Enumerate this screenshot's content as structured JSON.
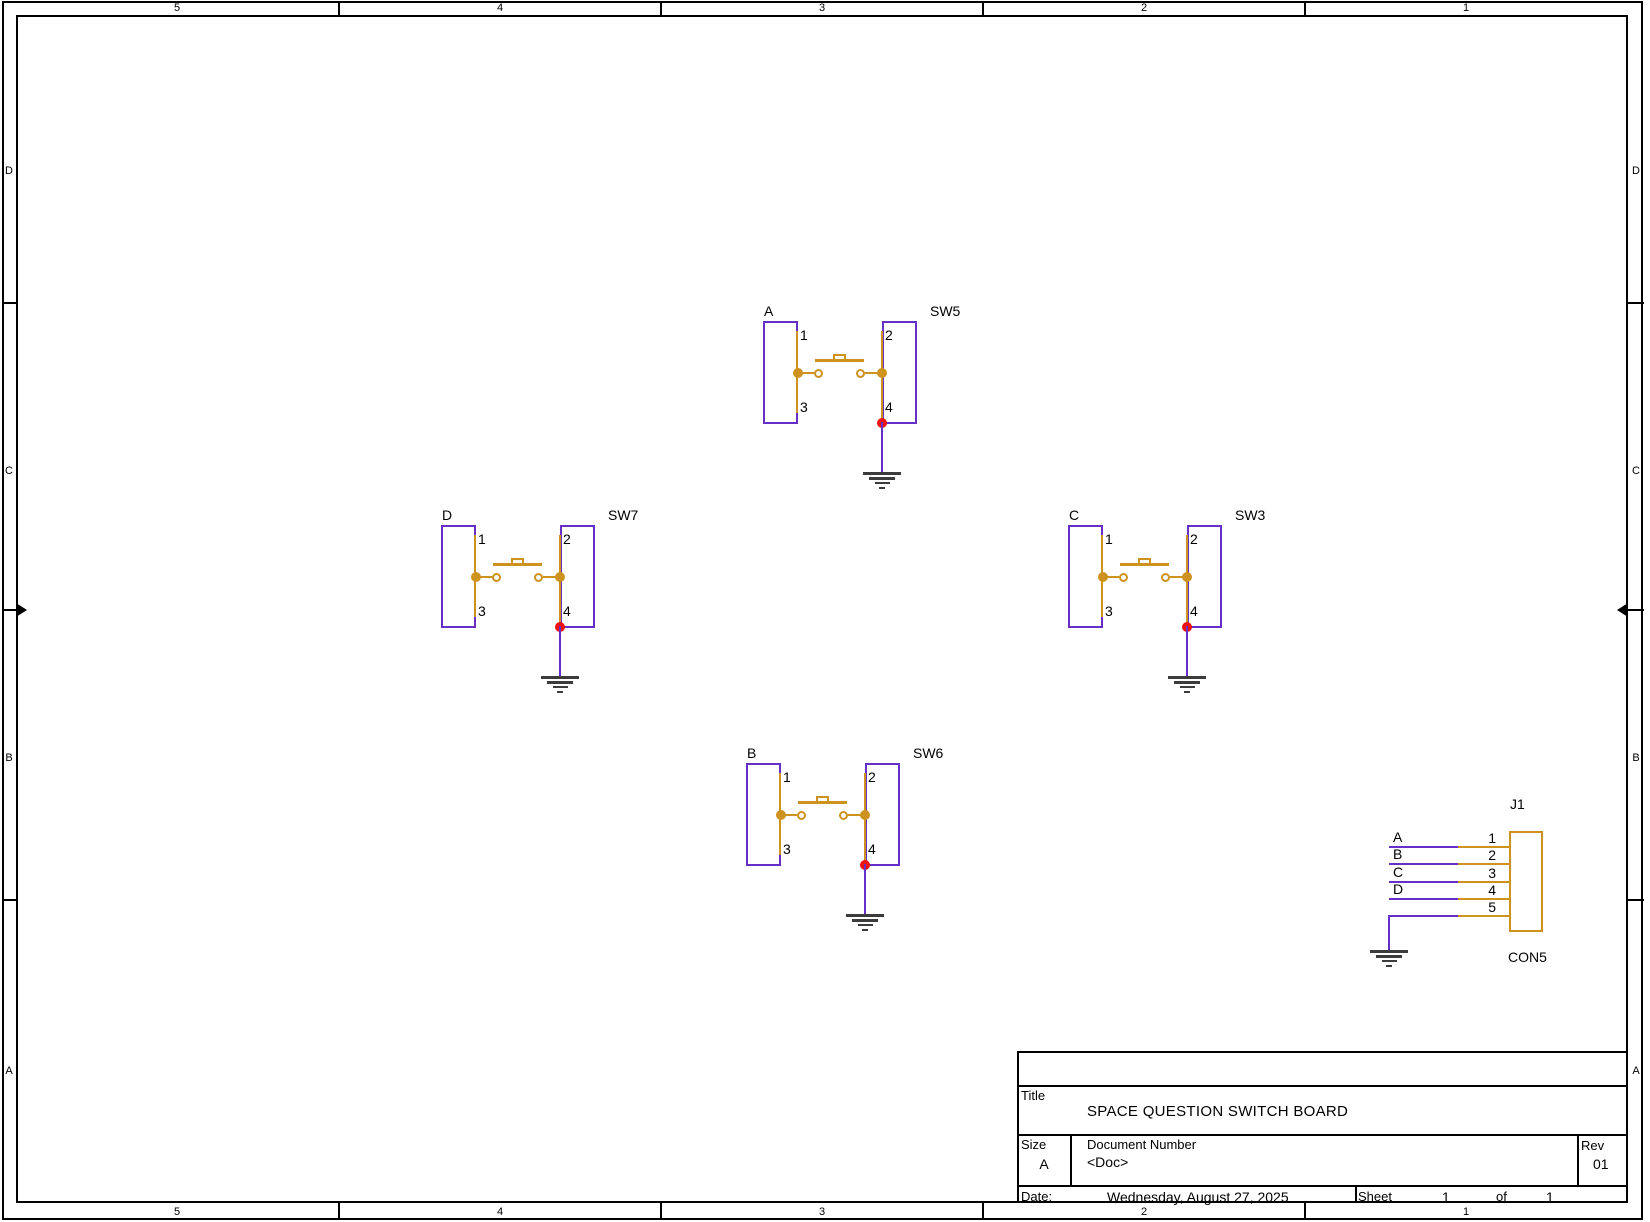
{
  "border": {
    "columns": [
      "5",
      "4",
      "3",
      "2",
      "1"
    ],
    "rows": [
      "D",
      "C",
      "B",
      "A"
    ]
  },
  "pin_numbers": [
    "1",
    "2",
    "3",
    "4"
  ],
  "switches": [
    {
      "name": "SW5",
      "net": "A"
    },
    {
      "name": "SW7",
      "net": "D"
    },
    {
      "name": "SW3",
      "net": "C"
    },
    {
      "name": "SW6",
      "net": "B"
    }
  ],
  "connector": {
    "name": "J1",
    "part": "CON5",
    "pins": [
      {
        "number": "1",
        "net": "A"
      },
      {
        "number": "2",
        "net": "B"
      },
      {
        "number": "3",
        "net": "C"
      },
      {
        "number": "4",
        "net": "D"
      },
      {
        "number": "5",
        "net": ""
      }
    ]
  },
  "title_block": {
    "title_label": "Title",
    "title": "SPACE QUESTION SWITCH BOARD",
    "size_label": "Size",
    "size": "A",
    "doc_label": "Document Number",
    "doc": "<Doc>",
    "rev_label": "Rev",
    "rev": "01",
    "date_label": "Date:",
    "date": "Wednesday, August 27, 2025",
    "sheet_label": "Sheet",
    "sheet": "1",
    "of_label": "of",
    "of_total": "1"
  },
  "colors": {
    "part_outline": "#6630C8",
    "wire": "#6630C8",
    "pin": "#CE921E",
    "junction": "#EE1111",
    "ground": "#3C3C3C",
    "frame": "#000000"
  }
}
